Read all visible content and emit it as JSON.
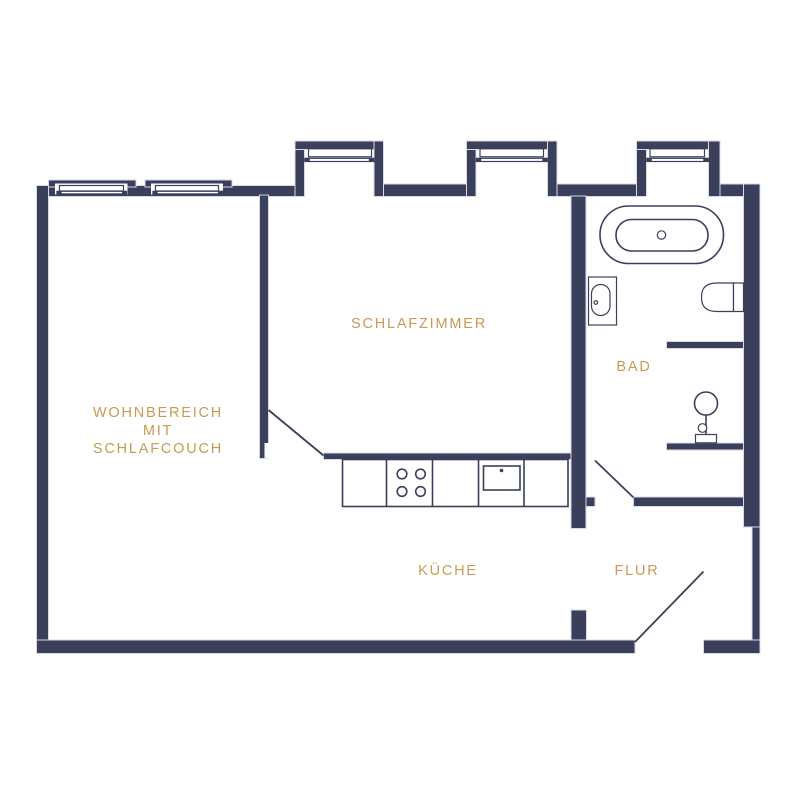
{
  "plan": {
    "colors": {
      "wall": "#3a3f5c",
      "wall_edge": "#d8dae6",
      "label": "#c89a52",
      "background": "#ffffff"
    },
    "rooms": [
      {
        "name": "wohnbereich-mit-schlafcouch",
        "label_lines": [
          "WOHNBEREICH",
          "MIT",
          "SCHLAFCOUCH"
        ]
      },
      {
        "name": "schlafzimmer",
        "label": "SCHLAFZIMMER"
      },
      {
        "name": "bad",
        "label": "BAD"
      },
      {
        "name": "kueche",
        "label": "KÜCHE"
      },
      {
        "name": "flur",
        "label": "FLUR"
      }
    ],
    "fixtures": [
      "bathtub",
      "washbasin",
      "toilet",
      "pedestal-stand",
      "kitchen-counter",
      "cooktop",
      "kitchen-sink"
    ],
    "openings": [
      "interior-door-kitchen",
      "interior-door-bath",
      "entrance-door"
    ]
  }
}
